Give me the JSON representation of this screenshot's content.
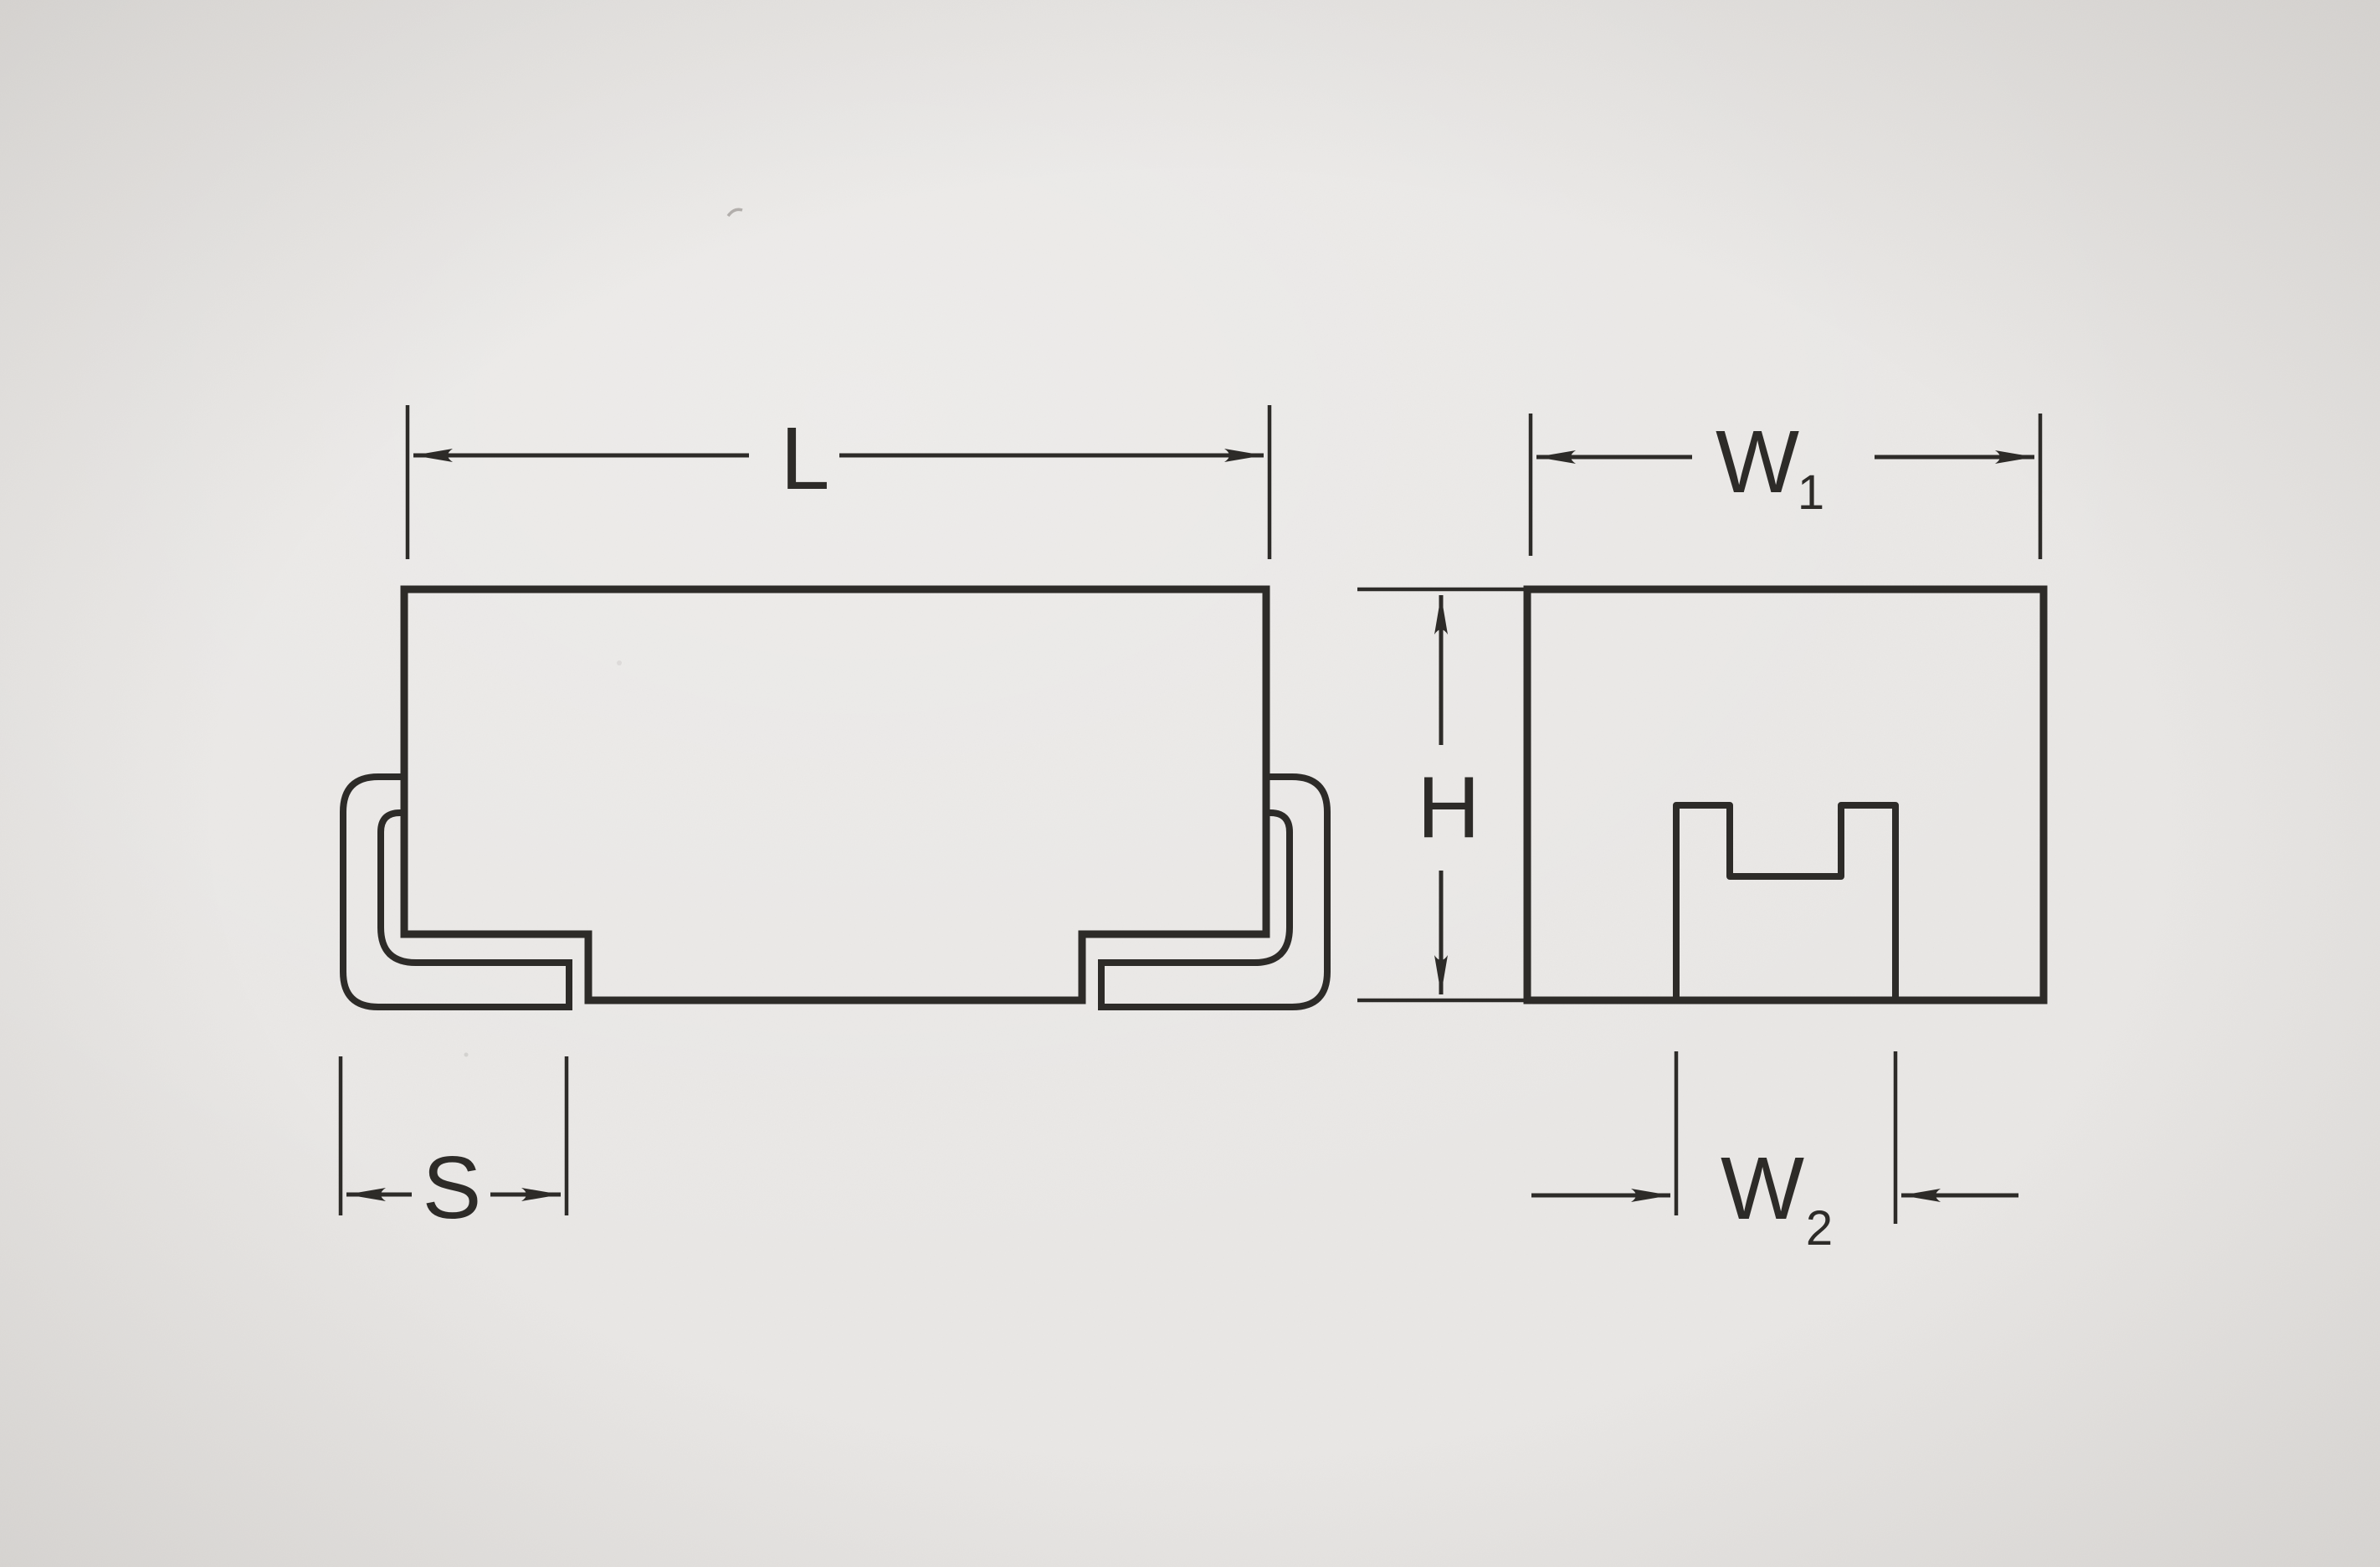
{
  "page": {
    "paper": "#e9e7e5",
    "ink": "#2d2b28"
  },
  "drawing": {
    "labels": {
      "length": "L",
      "lead_space": "S",
      "width1_base": "W",
      "width1_sub": "1",
      "height": "H",
      "width2_base": "W",
      "width2_sub": "2"
    }
  }
}
